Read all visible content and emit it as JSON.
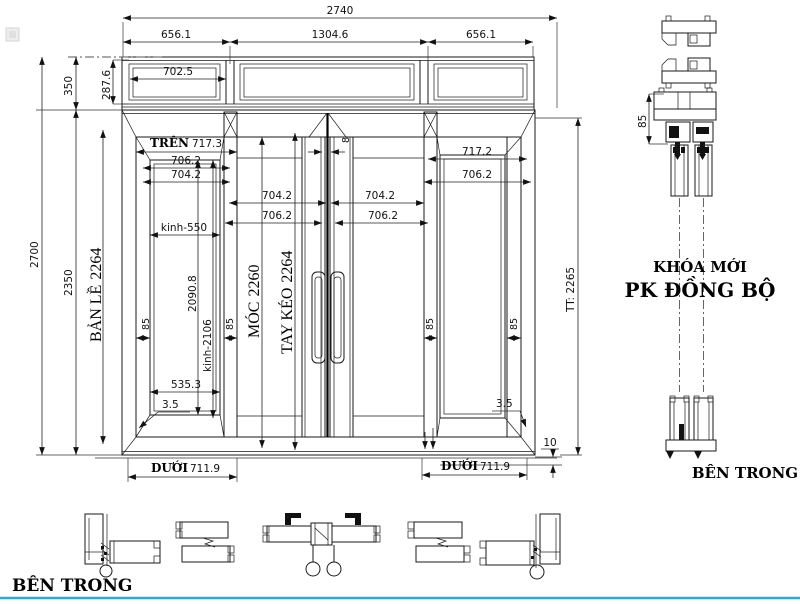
{
  "title": "4-panel sliding door shop drawing with transom",
  "colors": {
    "line": "#1a1a1a",
    "accent": "#29ABE2",
    "background": "#ffffff"
  },
  "elevation": {
    "top_dims": {
      "overall": "2740",
      "left": "656.1",
      "middle": "1304.6",
      "right": "656.1"
    },
    "transom": {
      "height": "350",
      "glass_width": "702.5",
      "glass_height": "287.6"
    },
    "left_dims": {
      "total_height": "2700",
      "door_height": "2350",
      "hinge_label": "BẢN LỀ",
      "hinge_height": "2264"
    },
    "panel_left": {
      "top_label": "TRÊN",
      "top_width": "717.3",
      "width_1": "706.2",
      "width_2": "704.2",
      "glass_width": "kinh-550",
      "glass_height": "2090.8",
      "glass_height_2": "kinh-2106",
      "stile_left": "85",
      "stile_right": "85",
      "bottom_width": "535.3",
      "gap": "3.5",
      "bottom_label": "DƯỚI",
      "bottom_dim": "711.9"
    },
    "panel_center": {
      "meeting_gap": "8",
      "hook_label": "MÓC",
      "hook_height": "2260",
      "handle_label": "TAY KÉO",
      "handle_height": "2264",
      "leaf_a_width_1": "704.2",
      "leaf_a_width_2": "706.2",
      "leaf_b_width_1": "704.2",
      "leaf_b_width_2": "706.2"
    },
    "panel_right": {
      "top_width": "717.2",
      "width_2": "706.2",
      "stile_left": "85",
      "stile_right": "85",
      "gap": "3.5",
      "bottom_label": "DƯỚI",
      "bottom_dim": "711.9",
      "track_height": "10",
      "overall_label": "TT: 2265"
    }
  },
  "section_right": {
    "profile_depth": "85",
    "note_line_1": "KHÓA MỚI",
    "note_line_2": "PK ĐỒNG BỘ",
    "caption": "BÊN TRONG"
  },
  "section_bottom": {
    "caption": "BÊN TRONG"
  }
}
